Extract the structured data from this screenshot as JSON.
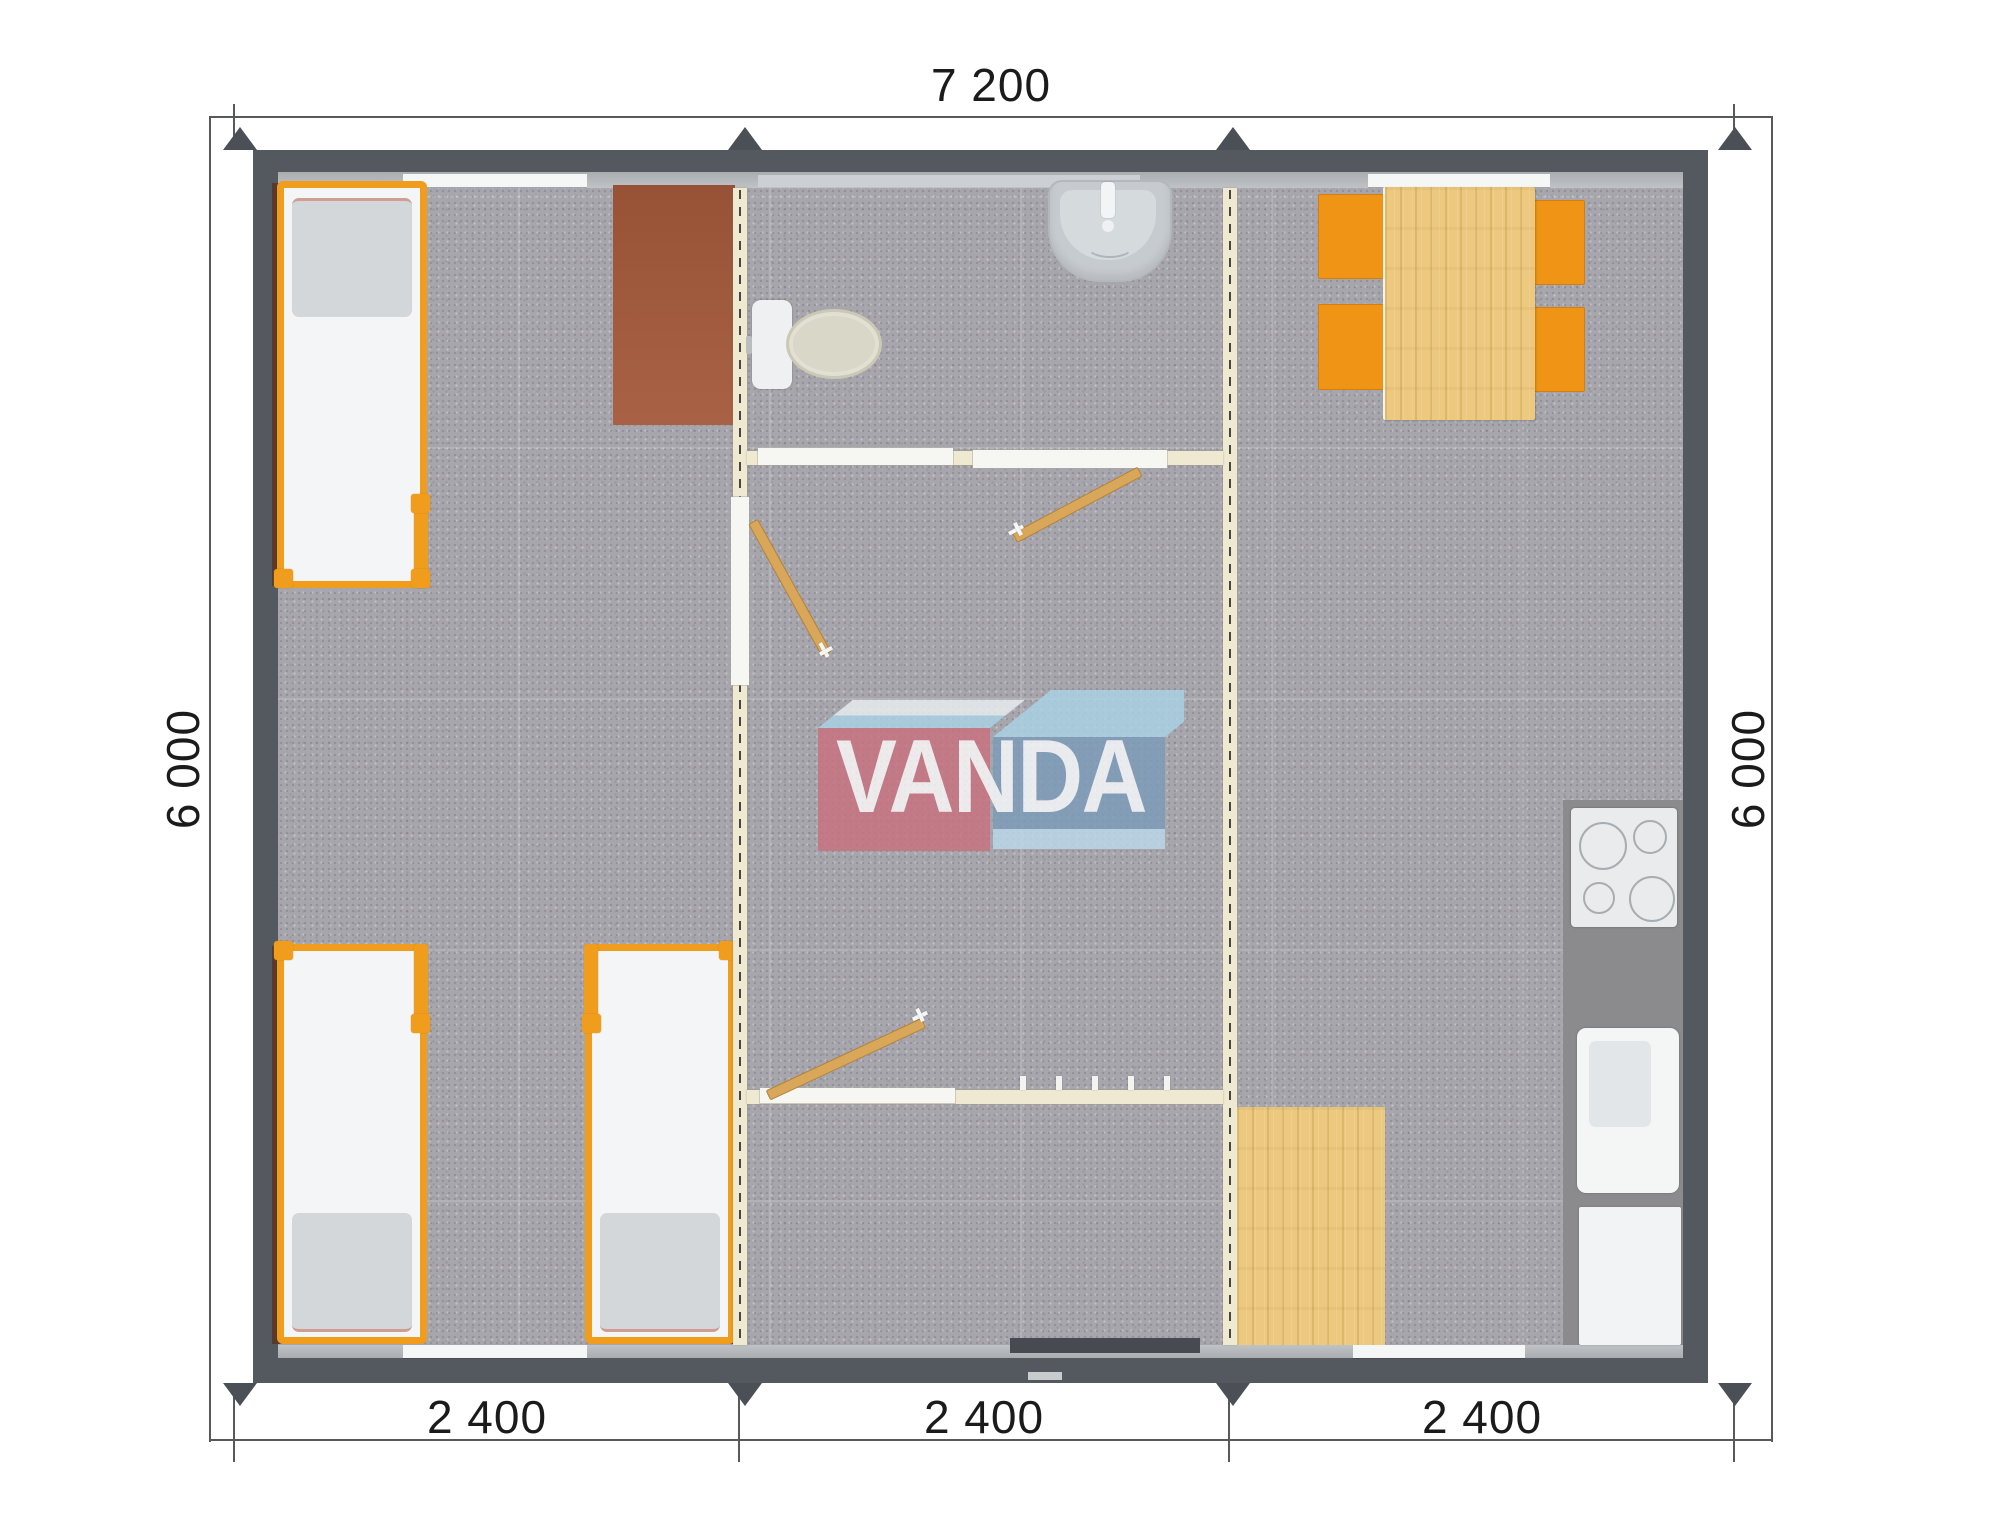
{
  "dimensions": {
    "top_width": "7 200",
    "left_height": "6 000",
    "right_height": "6 000",
    "bottom_segments": [
      "2 400",
      "2 400",
      "2 400"
    ]
  },
  "watermark": {
    "brand": "VANDA"
  },
  "colors": {
    "wall": "#54585f",
    "floor": "#a7a6ac",
    "partition": "#efe9d2",
    "orange": "#ef9414",
    "bed-frame": "#f09c1c",
    "wood": "#ecc97e",
    "desk": "#a4593b",
    "counter": "#8b8b8d",
    "door-wood": "#d9a75a",
    "logo-red": "#c8737f",
    "logo-blue": "#7e9cba",
    "logo-lightblue": "#a9d2e4",
    "dim-text": "#1b1b1b"
  }
}
